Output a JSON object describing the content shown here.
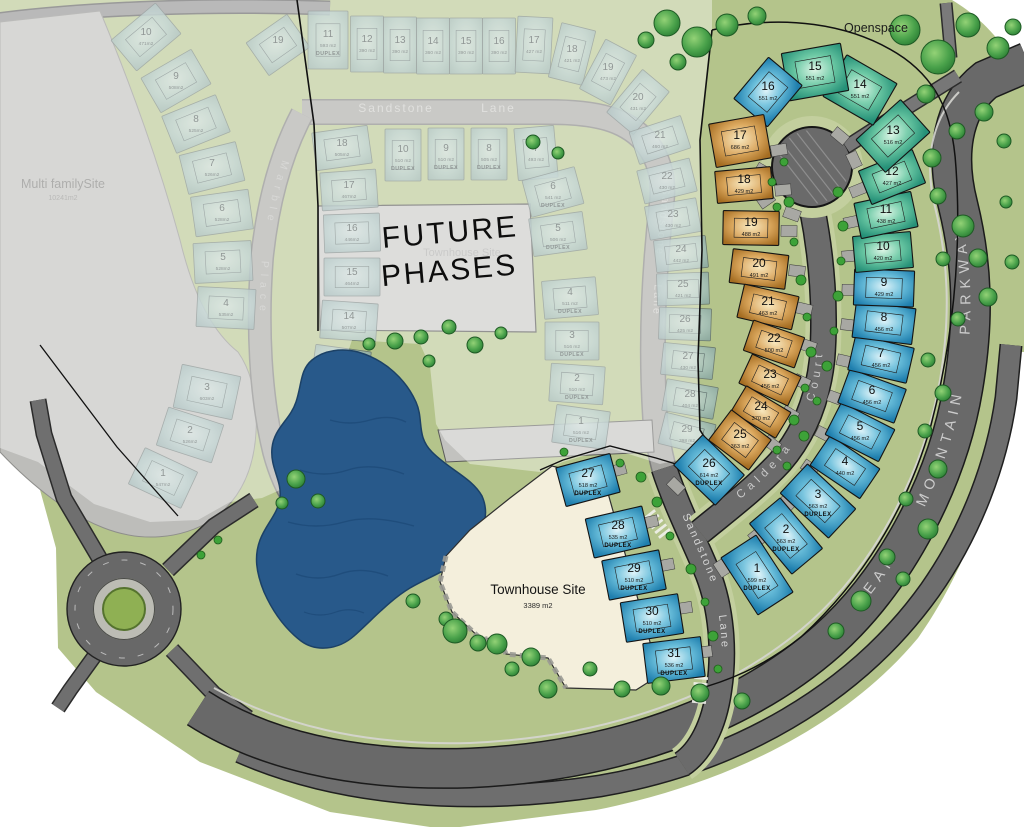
{
  "labels": {
    "openspace": "Openspace",
    "multi_family": {
      "name": "Multi familySite",
      "area": "10241m2"
    },
    "future_phases": {
      "line1": "FUTURE",
      "line2": "PHASES"
    },
    "future_townhouse": {
      "name": "Townhouse Site"
    },
    "townhouse": {
      "name": "Townhouse Site",
      "area": "3389 m2"
    },
    "streets": {
      "sandstone_top": "Sandstone Lane",
      "sandstone_mid": "Sandstone Lane",
      "sandstone_active": "Sandstone Lane",
      "caldera": "Caldera Court",
      "marble": "Marble Place",
      "parkway": "BEAR MOUNTAIN PARKWAY"
    }
  },
  "colors": {
    "ground": "#b4c48b",
    "road": "#696969",
    "faded_road": "#a5a5a1",
    "pond": "#28598a",
    "townhouse_fill": "#f4efdc",
    "future_gray": "#c6c6c3",
    "multi_family_gray": "#bdbdba",
    "lot_green": "#2fa07f",
    "lot_blue": "#1f7fae",
    "lot_orange": "#a96f22",
    "tree_green": "#2f8f3a"
  },
  "active_lots": [
    {
      "n": "1",
      "a": "599 m2",
      "d": 1,
      "x": 757,
      "y": 575,
      "r": 57,
      "w": 68,
      "h": 42,
      "c": "b"
    },
    {
      "n": "2",
      "a": "563 m2",
      "d": 1,
      "x": 786,
      "y": 536,
      "r": 50,
      "w": 66,
      "h": 40,
      "c": "b"
    },
    {
      "n": "3",
      "a": "563 m2",
      "d": 1,
      "x": 818,
      "y": 501,
      "r": 43,
      "w": 66,
      "h": 40,
      "c": "b"
    },
    {
      "n": "4",
      "a": "440 m2",
      "x": 845,
      "y": 467,
      "r": 34,
      "w": 60,
      "h": 36,
      "c": "b"
    },
    {
      "n": "5",
      "a": "456 m2",
      "x": 860,
      "y": 432,
      "r": 27,
      "w": 60,
      "h": 36,
      "c": "b"
    },
    {
      "n": "6",
      "a": "456 m2",
      "x": 872,
      "y": 396,
      "r": 20,
      "w": 60,
      "h": 36,
      "c": "b"
    },
    {
      "n": "7",
      "a": "456 m2",
      "x": 881,
      "y": 359,
      "r": 13,
      "w": 60,
      "h": 36,
      "c": "b"
    },
    {
      "n": "8",
      "a": "456 m2",
      "x": 884,
      "y": 323,
      "r": 7,
      "w": 60,
      "h": 36,
      "c": "b"
    },
    {
      "n": "9",
      "a": "429 m2",
      "x": 884,
      "y": 288,
      "r": 2,
      "w": 60,
      "h": 36,
      "c": "b"
    },
    {
      "n": "10",
      "a": "420 m2",
      "x": 883,
      "y": 252,
      "r": -5,
      "w": 58,
      "h": 36,
      "c": "g"
    },
    {
      "n": "11",
      "a": "438 m2",
      "x": 886,
      "y": 215,
      "r": -12,
      "w": 58,
      "h": 36,
      "c": "g"
    },
    {
      "n": "12",
      "a": "427 m2",
      "x": 892,
      "y": 177,
      "r": -22,
      "w": 58,
      "h": 36,
      "c": "g"
    },
    {
      "n": "13",
      "a": "516 m2",
      "x": 893,
      "y": 136,
      "r": -42,
      "w": 60,
      "h": 44,
      "c": "g"
    },
    {
      "n": "14",
      "a": "551 m2",
      "x": 860,
      "y": 90,
      "r": 30,
      "w": 58,
      "h": 48,
      "c": "g"
    },
    {
      "n": "15",
      "a": "551 m2",
      "x": 815,
      "y": 72,
      "r": -10,
      "w": 60,
      "h": 48,
      "c": "g"
    },
    {
      "n": "16",
      "a": "551 m2",
      "x": 768,
      "y": 92,
      "r": -50,
      "w": 54,
      "h": 44,
      "c": "b"
    },
    {
      "n": "17",
      "a": "686 m2",
      "x": 740,
      "y": 141,
      "r": -10,
      "w": 56,
      "h": 44,
      "c": "o"
    },
    {
      "n": "18",
      "a": "429 m2",
      "x": 744,
      "y": 185,
      "r": -5,
      "w": 56,
      "h": 32,
      "c": "o"
    },
    {
      "n": "19",
      "a": "488 m2",
      "x": 751,
      "y": 228,
      "r": 1,
      "w": 56,
      "h": 34,
      "c": "o"
    },
    {
      "n": "20",
      "a": "491 m2",
      "x": 759,
      "y": 269,
      "r": 7,
      "w": 56,
      "h": 34,
      "c": "o"
    },
    {
      "n": "21",
      "a": "463 m2",
      "x": 768,
      "y": 307,
      "r": 13,
      "w": 56,
      "h": 34,
      "c": "o"
    },
    {
      "n": "22",
      "a": "500 m2",
      "x": 774,
      "y": 344,
      "r": 19,
      "w": 54,
      "h": 32,
      "c": "o"
    },
    {
      "n": "23",
      "a": "456 m2",
      "x": 770,
      "y": 380,
      "r": 25,
      "w": 54,
      "h": 32,
      "c": "o"
    },
    {
      "n": "24",
      "a": "370 m2",
      "x": 761,
      "y": 412,
      "r": 31,
      "w": 52,
      "h": 30,
      "c": "o"
    },
    {
      "n": "25",
      "a": "363 m2",
      "x": 740,
      "y": 440,
      "r": 37,
      "w": 50,
      "h": 38,
      "c": "o"
    },
    {
      "n": "26",
      "a": "614 m2",
      "d": 1,
      "x": 709,
      "y": 470,
      "r": 44,
      "w": 58,
      "h": 42,
      "c": "b"
    },
    {
      "n": "27",
      "a": "518 m2",
      "d": 1,
      "x": 588,
      "y": 480,
      "r": -15,
      "w": 56,
      "h": 40,
      "c": "b"
    },
    {
      "n": "28",
      "a": "535 m2",
      "d": 1,
      "x": 618,
      "y": 532,
      "r": -13,
      "w": 58,
      "h": 40,
      "c": "b"
    },
    {
      "n": "29",
      "a": "510 m2",
      "d": 1,
      "x": 634,
      "y": 575,
      "r": -11,
      "w": 58,
      "h": 40,
      "c": "b"
    },
    {
      "n": "30",
      "a": "510 m2",
      "d": 1,
      "x": 652,
      "y": 618,
      "r": -9,
      "w": 58,
      "h": 40,
      "c": "b"
    },
    {
      "n": "31",
      "a": "536 m2",
      "d": 1,
      "x": 674,
      "y": 660,
      "r": -7,
      "w": 58,
      "h": 40,
      "c": "b"
    }
  ],
  "faded_lots": [
    {
      "n": "1",
      "a": "547m2",
      "x": 163,
      "y": 478,
      "r": 25,
      "w": 58,
      "h": 40
    },
    {
      "n": "2",
      "a": "526m2",
      "x": 190,
      "y": 435,
      "r": 18,
      "w": 58,
      "h": 40
    },
    {
      "n": "3",
      "a": "603m2",
      "x": 207,
      "y": 392,
      "r": 12,
      "w": 60,
      "h": 44
    },
    {
      "n": "4",
      "a": "535m2",
      "x": 226,
      "y": 308,
      "r": 3,
      "w": 58,
      "h": 40
    },
    {
      "n": "5",
      "a": "528m2",
      "x": 223,
      "y": 262,
      "r": -3,
      "w": 58,
      "h": 40
    },
    {
      "n": "6",
      "a": "528m2",
      "x": 222,
      "y": 213,
      "r": -8,
      "w": 58,
      "h": 40
    },
    {
      "n": "7",
      "a": "526m2",
      "x": 212,
      "y": 168,
      "r": -14,
      "w": 58,
      "h": 40
    },
    {
      "n": "8",
      "a": "525m2",
      "x": 196,
      "y": 124,
      "r": -22,
      "w": 58,
      "h": 40
    },
    {
      "n": "9",
      "a": "508m2",
      "x": 176,
      "y": 81,
      "r": -30,
      "w": 58,
      "h": 40
    },
    {
      "n": "10",
      "a": "471m2",
      "x": 146,
      "y": 37,
      "r": -40,
      "w": 58,
      "h": 40
    },
    {
      "n": "11",
      "a": "476m2",
      "x": 308,
      "y": 458,
      "r": 22,
      "w": 56,
      "h": 38
    },
    {
      "n": "12",
      "a": "478m2",
      "x": 324,
      "y": 415,
      "r": 15,
      "w": 56,
      "h": 38
    },
    {
      "n": "13",
      "a": "519m2",
      "x": 341,
      "y": 367,
      "r": 8,
      "w": 56,
      "h": 38
    },
    {
      "n": "14",
      "a": "507m2",
      "x": 349,
      "y": 321,
      "r": 4,
      "w": 56,
      "h": 38
    },
    {
      "n": "15",
      "a": "464m2",
      "x": 352,
      "y": 277,
      "r": 0,
      "w": 56,
      "h": 38
    },
    {
      "n": "16",
      "a": "446m2",
      "x": 352,
      "y": 233,
      "r": -2,
      "w": 56,
      "h": 38
    },
    {
      "n": "17",
      "a": "467m2",
      "x": 349,
      "y": 190,
      "r": -4,
      "w": 56,
      "h": 38
    },
    {
      "n": "18",
      "a": "505m2",
      "x": 342,
      "y": 148,
      "r": -8,
      "w": 56,
      "h": 38
    },
    {
      "n": "19",
      "a": "",
      "x": 278,
      "y": 45,
      "r": -35,
      "w": 50,
      "h": 40
    },
    {
      "n": "11",
      "a": "593 m2",
      "d": 1,
      "x": 328,
      "y": 40,
      "r": 0,
      "w": 40,
      "h": 58
    },
    {
      "n": "12",
      "a": "390 m2",
      "x": 367,
      "y": 44,
      "r": 0,
      "w": 33,
      "h": 56
    },
    {
      "n": "13",
      "a": "390 m2",
      "x": 400,
      "y": 45,
      "r": 0,
      "w": 33,
      "h": 56
    },
    {
      "n": "14",
      "a": "360 m2",
      "x": 433,
      "y": 46,
      "r": 0,
      "w": 33,
      "h": 56
    },
    {
      "n": "15",
      "a": "390 m2",
      "x": 466,
      "y": 46,
      "r": 0,
      "w": 33,
      "h": 56
    },
    {
      "n": "16",
      "a": "390 m2",
      "x": 499,
      "y": 46,
      "r": 0,
      "w": 33,
      "h": 56
    },
    {
      "n": "17",
      "a": "427 m2",
      "x": 534,
      "y": 45,
      "r": 3,
      "w": 35,
      "h": 56
    },
    {
      "n": "18",
      "a": "421 m2",
      "x": 572,
      "y": 54,
      "r": 14,
      "w": 35,
      "h": 56
    },
    {
      "n": "19",
      "a": "473 m2",
      "x": 608,
      "y": 72,
      "r": 28,
      "w": 35,
      "h": 56
    },
    {
      "n": "20",
      "a": "431 m2",
      "x": 638,
      "y": 102,
      "r": 40,
      "w": 35,
      "h": 56
    },
    {
      "n": "21",
      "a": "460 m2",
      "x": 660,
      "y": 140,
      "r": -18,
      "w": 54,
      "h": 34
    },
    {
      "n": "22",
      "a": "430 m2",
      "x": 667,
      "y": 181,
      "r": -14,
      "w": 54,
      "h": 34
    },
    {
      "n": "23",
      "a": "430 m2",
      "x": 673,
      "y": 219,
      "r": -10,
      "w": 52,
      "h": 34
    },
    {
      "n": "24",
      "a": "442 m2",
      "x": 681,
      "y": 254,
      "r": -6,
      "w": 52,
      "h": 32
    },
    {
      "n": "25",
      "a": "421 m2",
      "x": 683,
      "y": 289,
      "r": -2,
      "w": 52,
      "h": 32
    },
    {
      "n": "26",
      "a": "425 m2",
      "x": 685,
      "y": 324,
      "r": 2,
      "w": 52,
      "h": 32
    },
    {
      "n": "27",
      "a": "430 m2",
      "x": 688,
      "y": 361,
      "r": 6,
      "w": 52,
      "h": 32
    },
    {
      "n": "28",
      "a": "404 m2",
      "x": 690,
      "y": 399,
      "r": 10,
      "w": 52,
      "h": 32
    },
    {
      "n": "29",
      "a": "398 m2",
      "x": 687,
      "y": 434,
      "r": 14,
      "w": 52,
      "h": 32
    },
    {
      "n": "10",
      "a": "510 m2",
      "d": 1,
      "x": 403,
      "y": 155,
      "r": 0,
      "w": 36,
      "h": 52
    },
    {
      "n": "9",
      "a": "510 m2",
      "d": 1,
      "x": 446,
      "y": 154,
      "r": 0,
      "w": 36,
      "h": 52
    },
    {
      "n": "8",
      "a": "505 m2",
      "d": 1,
      "x": 489,
      "y": 154,
      "r": 0,
      "w": 36,
      "h": 52
    },
    {
      "n": "7",
      "a": "493 m2",
      "x": 536,
      "y": 153,
      "r": -5,
      "w": 40,
      "h": 52
    },
    {
      "n": "6",
      "a": "541 m2",
      "d": 1,
      "x": 553,
      "y": 192,
      "r": -15,
      "w": 54,
      "h": 38
    },
    {
      "n": "5",
      "a": "506 m2",
      "d": 1,
      "x": 558,
      "y": 234,
      "r": -8,
      "w": 54,
      "h": 38
    },
    {
      "n": "4",
      "a": "511 m2",
      "d": 1,
      "x": 570,
      "y": 298,
      "r": -5,
      "w": 54,
      "h": 38
    },
    {
      "n": "3",
      "a": "516 m2",
      "d": 1,
      "x": 572,
      "y": 341,
      "r": 0,
      "w": 54,
      "h": 38
    },
    {
      "n": "2",
      "a": "510 m2",
      "d": 1,
      "x": 577,
      "y": 384,
      "r": 4,
      "w": 54,
      "h": 38
    },
    {
      "n": "1",
      "a": "516 m2",
      "d": 1,
      "x": 581,
      "y": 427,
      "r": 8,
      "w": 54,
      "h": 38
    }
  ],
  "pads": [
    [
      792,
      214,
      20
    ],
    [
      766,
      200,
      -35
    ],
    [
      760,
      172,
      -60
    ],
    [
      840,
      136,
      40
    ],
    [
      854,
      160,
      65
    ],
    [
      858,
      190,
      -22
    ],
    [
      852,
      222,
      -12
    ],
    [
      850,
      256,
      -5
    ],
    [
      850,
      290,
      2
    ],
    [
      849,
      325,
      7
    ],
    [
      845,
      361,
      13
    ],
    [
      836,
      398,
      20
    ],
    [
      824,
      434,
      27
    ],
    [
      810,
      468,
      34
    ],
    [
      787,
      503,
      43
    ],
    [
      757,
      538,
      50
    ],
    [
      722,
      568,
      57
    ],
    [
      779,
      150,
      -10
    ],
    [
      783,
      190,
      -5
    ],
    [
      789,
      231,
      1
    ],
    [
      797,
      271,
      7
    ],
    [
      804,
      309,
      13
    ],
    [
      808,
      346,
      19
    ],
    [
      802,
      382,
      25
    ],
    [
      790,
      414,
      31
    ],
    [
      772,
      444,
      37
    ],
    [
      676,
      486,
      44
    ],
    [
      618,
      470,
      -15
    ],
    [
      650,
      522,
      -13
    ],
    [
      666,
      565,
      -11
    ],
    [
      684,
      608,
      -9
    ],
    [
      704,
      652,
      -7
    ]
  ],
  "trees": [
    [
      667,
      23,
      13
    ],
    [
      697,
      42,
      15
    ],
    [
      727,
      25,
      11
    ],
    [
      757,
      16,
      9
    ],
    [
      678,
      62,
      8
    ],
    [
      646,
      40,
      8
    ],
    [
      905,
      30,
      15
    ],
    [
      938,
      57,
      17
    ],
    [
      968,
      25,
      12
    ],
    [
      998,
      48,
      11
    ],
    [
      1013,
      27,
      8
    ],
    [
      926,
      94,
      9
    ],
    [
      932,
      158,
      9
    ],
    [
      957,
      131,
      8
    ],
    [
      984,
      112,
      9
    ],
    [
      1004,
      141,
      7
    ],
    [
      938,
      196,
      8
    ],
    [
      963,
      226,
      11
    ],
    [
      978,
      258,
      9
    ],
    [
      943,
      259,
      7
    ],
    [
      988,
      297,
      9
    ],
    [
      958,
      319,
      7
    ],
    [
      1012,
      262,
      7
    ],
    [
      1006,
      202,
      6
    ],
    [
      928,
      360,
      7
    ],
    [
      943,
      393,
      8
    ],
    [
      925,
      431,
      7
    ],
    [
      938,
      469,
      9
    ],
    [
      906,
      499,
      7
    ],
    [
      928,
      529,
      10
    ],
    [
      887,
      557,
      8
    ],
    [
      903,
      579,
      7
    ],
    [
      861,
      601,
      10
    ],
    [
      836,
      631,
      8
    ],
    [
      700,
      693,
      9
    ],
    [
      742,
      701,
      8
    ],
    [
      661,
      686,
      9
    ],
    [
      622,
      689,
      8
    ],
    [
      590,
      669,
      7
    ],
    [
      548,
      689,
      9
    ],
    [
      512,
      669,
      7
    ],
    [
      478,
      643,
      8
    ],
    [
      446,
      619,
      7
    ],
    [
      413,
      601,
      7
    ],
    [
      296,
      479,
      9
    ],
    [
      318,
      501,
      7
    ],
    [
      282,
      503,
      6
    ],
    [
      395,
      341,
      8
    ],
    [
      421,
      337,
      7
    ],
    [
      449,
      327,
      7
    ],
    [
      475,
      345,
      8
    ],
    [
      501,
      333,
      6
    ],
    [
      429,
      361,
      6
    ],
    [
      369,
      344,
      6
    ],
    [
      533,
      142,
      7
    ],
    [
      558,
      153,
      6
    ],
    [
      455,
      631,
      12
    ],
    [
      497,
      644,
      10
    ],
    [
      531,
      657,
      9
    ]
  ],
  "bushes": [
    [
      838,
      192,
      5
    ],
    [
      843,
      226,
      5
    ],
    [
      841,
      261,
      4
    ],
    [
      838,
      296,
      5
    ],
    [
      834,
      331,
      4
    ],
    [
      827,
      366,
      5
    ],
    [
      817,
      401,
      4
    ],
    [
      804,
      436,
      5
    ],
    [
      787,
      466,
      4
    ],
    [
      784,
      162,
      4
    ],
    [
      789,
      202,
      5
    ],
    [
      794,
      242,
      4
    ],
    [
      801,
      280,
      5
    ],
    [
      807,
      317,
      4
    ],
    [
      811,
      352,
      5
    ],
    [
      805,
      388,
      4
    ],
    [
      794,
      420,
      5
    ],
    [
      777,
      450,
      4
    ],
    [
      657,
      502,
      5
    ],
    [
      670,
      536,
      4
    ],
    [
      691,
      569,
      5
    ],
    [
      705,
      602,
      4
    ],
    [
      713,
      636,
      5
    ],
    [
      718,
      669,
      4
    ],
    [
      777,
      207,
      4
    ],
    [
      772,
      182,
      4
    ],
    [
      641,
      477,
      5
    ],
    [
      620,
      463,
      4
    ],
    [
      564,
      452,
      4
    ],
    [
      201,
      555,
      4
    ],
    [
      218,
      540,
      4
    ]
  ]
}
